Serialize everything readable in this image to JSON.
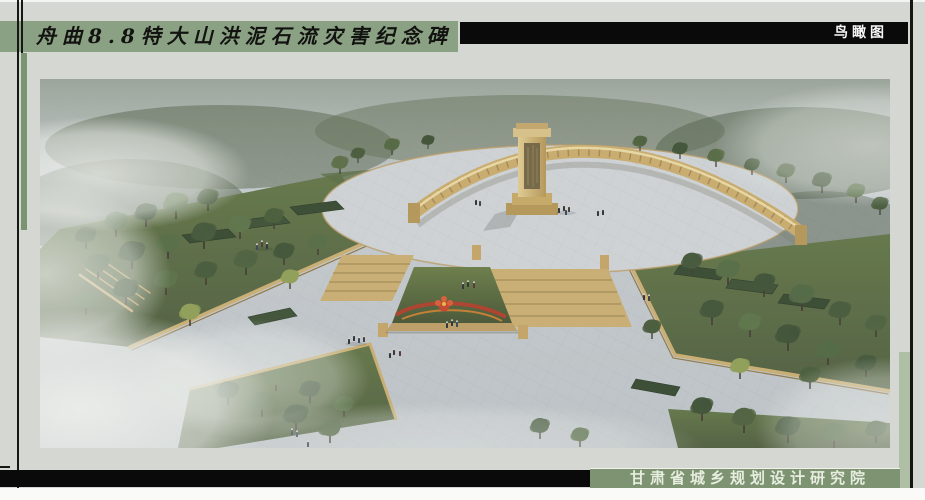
{
  "header": {
    "title": "舟曲8.8特大山洪泥石流灾害纪念碑",
    "view_label": "鸟瞰图"
  },
  "footer": {
    "institute": "甘肃省城乡规划设计研究院"
  },
  "colors": {
    "background": "#d4d7d2",
    "title_banner": "#8ba184",
    "band_black": "#0a0a0a",
    "footer_band": "#7d9372",
    "accent_strip": "#7a9472",
    "right_strip": "#aebfa6",
    "title_text": "#121310",
    "band_text": "#f5f5f5",
    "footer_text": "#e7eedf"
  }
}
